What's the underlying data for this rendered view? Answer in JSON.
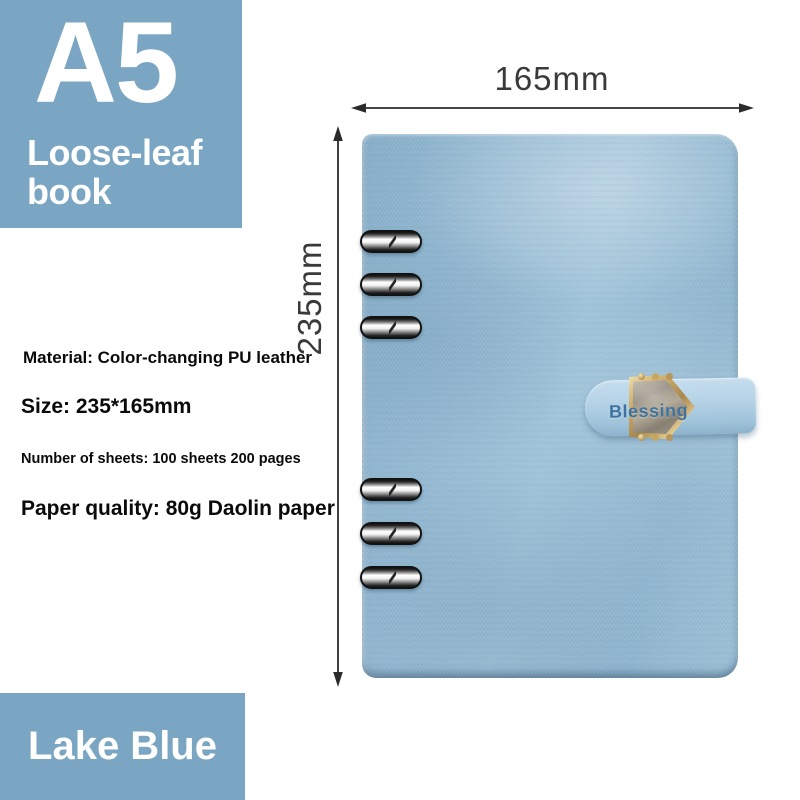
{
  "badge": {
    "size": "A5",
    "type": "Loose-leaf book"
  },
  "specs": {
    "material": "Material: Color-changing PU leather",
    "size": "Size: 235*165mm",
    "sheets": "Number of sheets: 100 sheets 200 pages",
    "paper": "Paper quality: 80g Daolin paper"
  },
  "dimensions": {
    "width": "165mm",
    "height": "235mm"
  },
  "clasp": {
    "text": "Blessing"
  },
  "color_name": "Lake Blue",
  "colors": {
    "label_box_blue": "#7aa6c3",
    "cover_blue": "#92b8d1",
    "strap_blue": "#b4d2e6",
    "clasp_text_blue": "#3f739e",
    "buckle_gold": "#c9a865",
    "ring_chrome": "#f2f2f2",
    "dimension_ink": "#3a3a3a",
    "spec_ink": "#0a0a0a",
    "background": "#ffffff"
  }
}
